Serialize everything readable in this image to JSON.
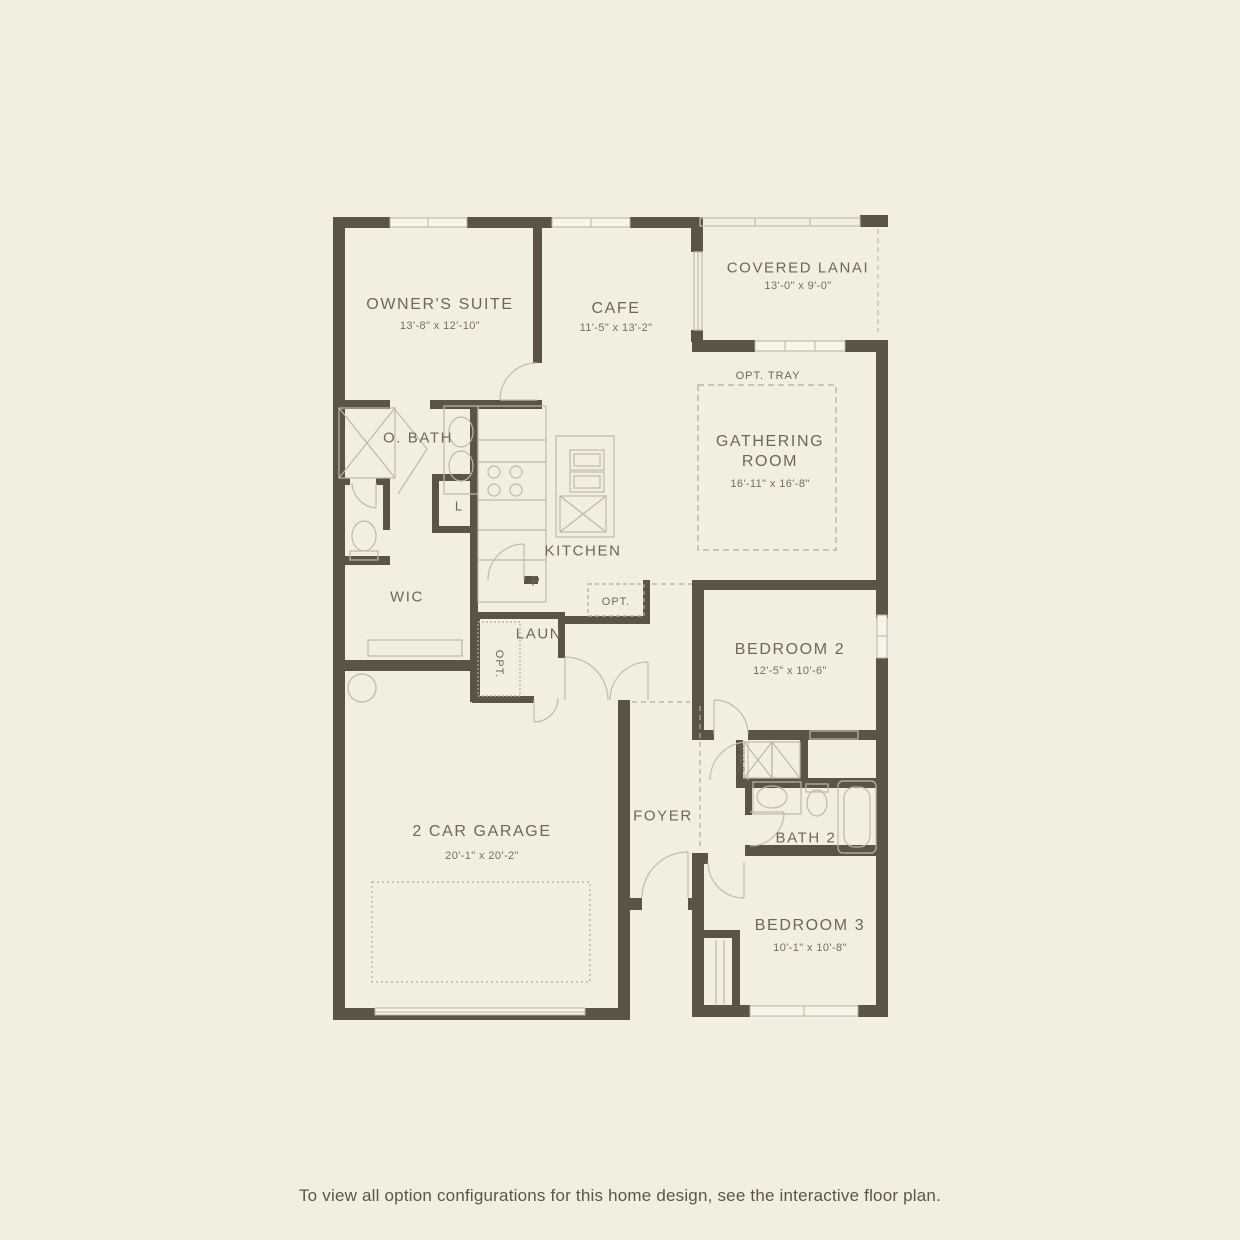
{
  "colors": {
    "background": "#f2efe1",
    "walls": "#5b5346",
    "thin_lines": "#bfb8a6",
    "dashed_lines": "#b3ab99",
    "labels": "#6e6759",
    "caption": "#5c564a"
  },
  "rooms": {
    "owners_suite": {
      "name": "OWNER'S SUITE",
      "dims": "13'-8\" x 12'-10\""
    },
    "cafe": {
      "name": "CAFE",
      "dims": "11'-5\" x 13'-2\""
    },
    "covered_lanai": {
      "name": "COVERED LANAI",
      "dims": "13'-0\" x 9'-0\""
    },
    "gathering_room": {
      "name": "GATHERING ROOM",
      "dims": "16'-11\" x 16'-8\""
    },
    "opt_tray": {
      "name": "OPT. TRAY"
    },
    "o_bath": {
      "name": "O. BATH"
    },
    "linen": {
      "name": "L"
    },
    "wic": {
      "name": "WIC"
    },
    "kitchen": {
      "name": "KITCHEN"
    },
    "pantry": {
      "name": "P"
    },
    "kitchen_opt": {
      "name": "OPT."
    },
    "laundry": {
      "name": "LAUN"
    },
    "laundry_opt": {
      "name": "OPT."
    },
    "hvac": {
      "name": "HVAC"
    },
    "foyer": {
      "name": "FOYER"
    },
    "bedroom_2": {
      "name": "BEDROOM 2",
      "dims": "12'-5\" x 10'-6\""
    },
    "bath_2": {
      "name": "BATH 2"
    },
    "bedroom_3": {
      "name": "BEDROOM 3",
      "dims": "10'-1\" x 10'-8\""
    },
    "garage": {
      "name": "2 CAR GARAGE",
      "dims": "20'-1\" x 20'-2\""
    }
  },
  "caption": "To view all option configurations for this home design, see the interactive floor plan."
}
